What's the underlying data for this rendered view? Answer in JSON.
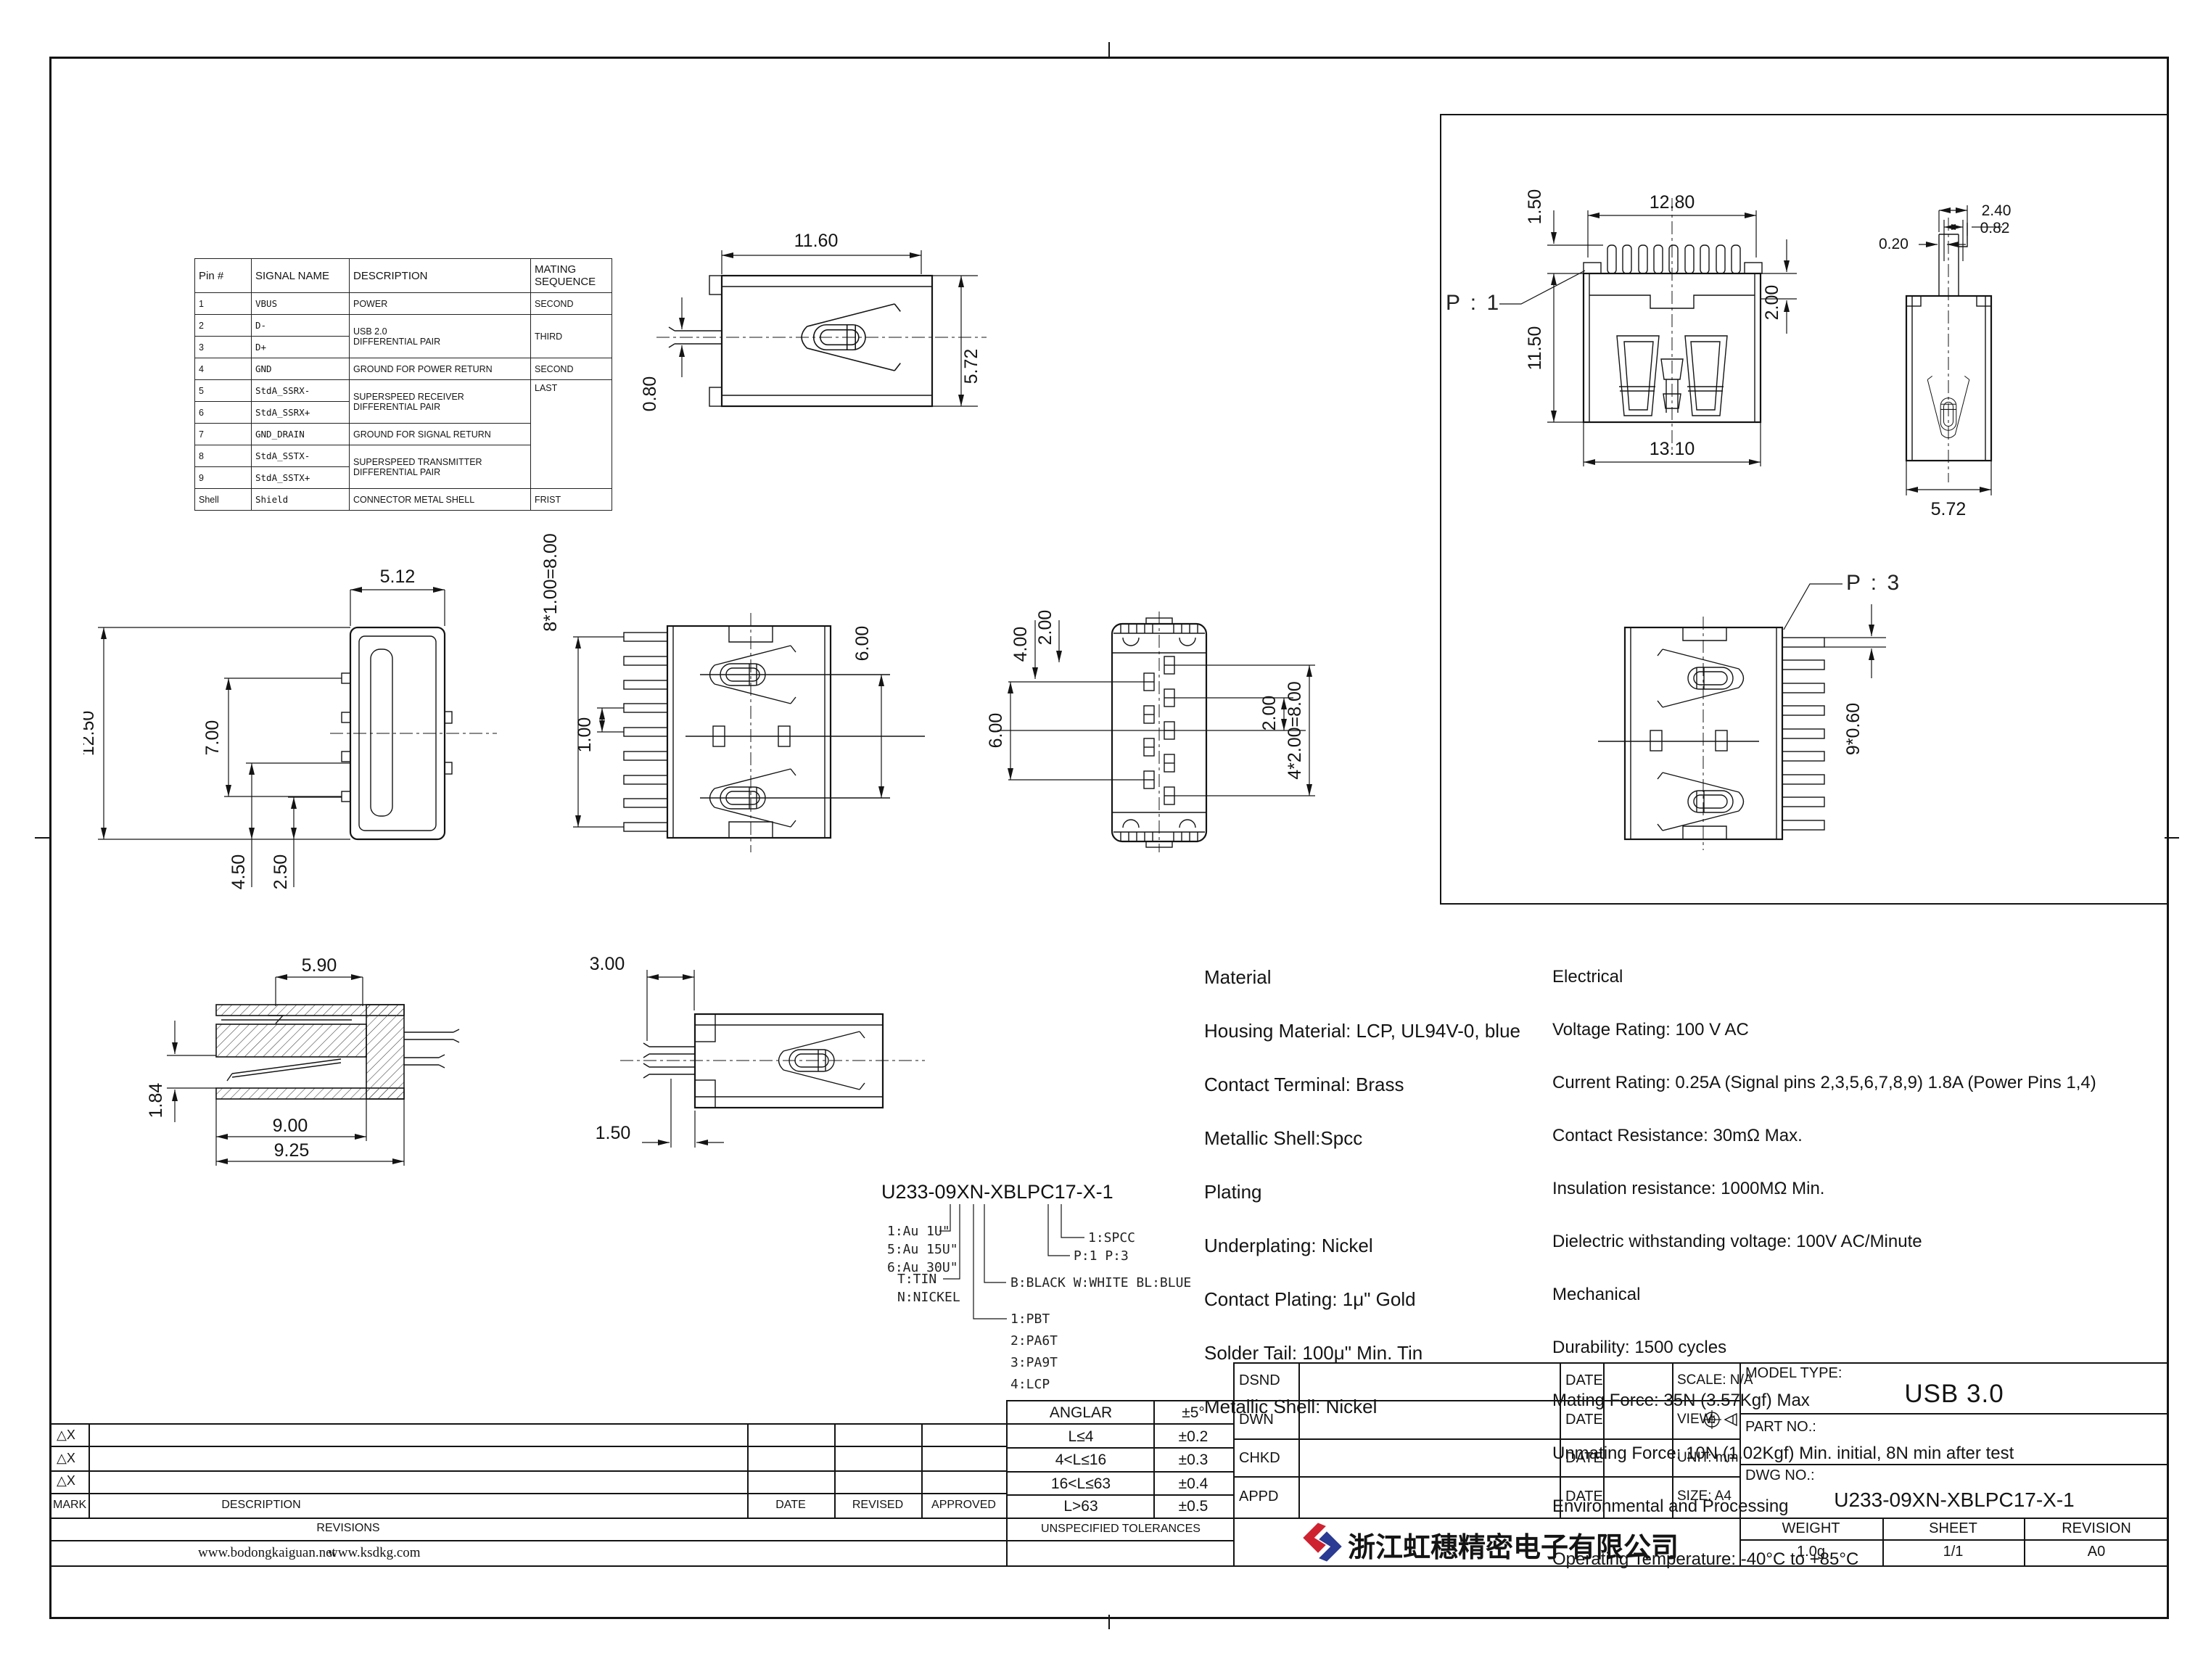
{
  "pin_table": {
    "headers": [
      "Pin #",
      "SIGNAL NAME",
      "DESCRIPTION",
      "MATING SEQUENCE"
    ],
    "rows": [
      {
        "pin": "1",
        "signal": "VBUS",
        "desc": "POWER",
        "mate": "SECOND"
      },
      {
        "pin": "2",
        "signal": "D-",
        "desc": "USB 2.0\nDIFFERENTIAL PAIR",
        "mate": "THIRD"
      },
      {
        "pin": "3",
        "signal": "D+"
      },
      {
        "pin": "4",
        "signal": "GND",
        "desc": "GROUND FOR POWER RETURN",
        "mate": "SECOND"
      },
      {
        "pin": "5",
        "signal": "StdA_SSRX-",
        "desc": "SUPERSPEED RECEIVER\nDIFFERENTIAL PAIR",
        "mate": "LAST"
      },
      {
        "pin": "6",
        "signal": "StdA_SSRX+"
      },
      {
        "pin": "7",
        "signal": "GND_DRAIN",
        "desc": "GROUND FOR SIGNAL RETURN"
      },
      {
        "pin": "8",
        "signal": "StdA_SSTX-",
        "desc": "SUPERSPEED TRANSMITTER\nDIFFERENTIAL PAIR"
      },
      {
        "pin": "9",
        "signal": "StdA_SSTX+"
      },
      {
        "pin": "Shell",
        "signal": "Shield",
        "desc": "CONNECTOR METAL SHELL",
        "mate": "FRIST"
      }
    ]
  },
  "views": {
    "side": {
      "w": "11.60",
      "h": "5.72",
      "pin": "0.80"
    },
    "front": {
      "label": "P : 1",
      "top": "12.80",
      "lip": "1.50",
      "h": "11.50",
      "bottom": "13.10",
      "side": "2.00"
    },
    "stem": {
      "a": "2.40",
      "b": "0.82",
      "c": "0.20",
      "w": "5.72"
    },
    "profile": {
      "top": "5.12",
      "h": "12.50",
      "mid": "7.00",
      "d1": "4.50",
      "d2": "2.50"
    },
    "top_left": {
      "pitch": "8*1.00=8.00",
      "pin": "1.00",
      "span": "6.00"
    },
    "bottom": {
      "d1": "4.00",
      "d2": "2.00",
      "left": "6.00",
      "right": "2.00",
      "pitch": "4*2.00=8.00"
    },
    "top_right": {
      "label": "P : 3",
      "pitch": "9*0.60"
    },
    "section": {
      "top": "5.90",
      "h": "1.84",
      "w1": "9.00",
      "w2": "9.25"
    },
    "tail": {
      "a": "3.00",
      "b": "1.50"
    }
  },
  "part_number": {
    "title": "U233-09XN-XBLPC17-X-1",
    "gold": [
      "1:Au 1U\"",
      "5:Au 15U\"",
      "6:Au 30U\""
    ],
    "plating": [
      "T:TIN",
      "N:NICKEL"
    ],
    "housing": [
      "1:PBT",
      "2:PA6T",
      "3:PA9T",
      "4:LCP"
    ],
    "colors": "B:BLACK W:WHITE  BL:BLUE",
    "ports": "P:1   P:3",
    "shell": "1:SPCC"
  },
  "materials": {
    "lines": [
      "Material",
      "Housing Material: LCP, UL94V-0, blue",
      "Contact Terminal: Brass",
      "Metallic Shell:Spcc",
      "Plating",
      "Underplating: Nickel",
      "Contact Plating: 1μ\" Gold",
      "Solder Tail: 100μ\" Min. Tin",
      "Metallic Shell: Nickel"
    ]
  },
  "electrical": {
    "lines": [
      "Electrical",
      "Voltage Rating: 100 V AC",
      "Current Rating: 0.25A (Signal pins 2,3,5,6,7,8,9) 1.8A (Power Pins 1,4)",
      "Contact Resistance: 30mΩ Max.",
      "Insulation resistance: 1000MΩ Min.",
      "Dielectric withstanding voltage: 100V AC/Minute",
      "Mechanical",
      "Durability: 1500 cycles",
      "Mating Force: 35N (3.57Kgf) Max",
      "Unmating Force: 10N (1.02Kgf) Min. initial, 8N min after test",
      "Environmental and Processing",
      "Operating Temperature: -40°C to +85°C"
    ]
  },
  "tolerances": {
    "rows": [
      {
        "range": "ANGLAR",
        "tol": "±5°"
      },
      {
        "range": "L≤4",
        "tol": "±0.2"
      },
      {
        "range": "4<L≤16",
        "tol": "±0.3"
      },
      {
        "range": "16<L≤63",
        "tol": "±0.4"
      },
      {
        "range": "L>63",
        "tol": "±0.5"
      }
    ],
    "footer": "UNSPECIFIED TOLERANCES"
  },
  "revisions": {
    "marks": [
      "△X",
      "△X",
      "△X"
    ],
    "mark_label": "MARK",
    "desc_label": "DESCRIPTION",
    "date_label": "DATE",
    "revised_label": "REVISED",
    "approved_label": "APPROVED",
    "title": "REVISIONS",
    "websites": [
      "www.bodongkaiguan.net",
      "www.ksdkg.com"
    ]
  },
  "title_block": {
    "sign_labels": [
      "DSND",
      "DWN",
      "CHKD",
      "APPD"
    ],
    "date": "DATE",
    "scale": "SCALE: N/A",
    "view": "VIEW:",
    "unit": "UNIT: mm",
    "size": "SIZE: A4",
    "model_label": "MODEL TYPE:",
    "model": "USB 3.0",
    "part_label": "PART NO.:",
    "dwg_label": "DWG NO.:",
    "dwg_no": "U233-09XN-XBLPC17-X-1",
    "weight_label": "WEIGHT",
    "sheet_label": "SHEET",
    "revision_label": "REVISION",
    "weight": "1.0g",
    "sheet": "1/1",
    "revision": "A0",
    "company": "浙江虹穗精密电子有限公司"
  }
}
